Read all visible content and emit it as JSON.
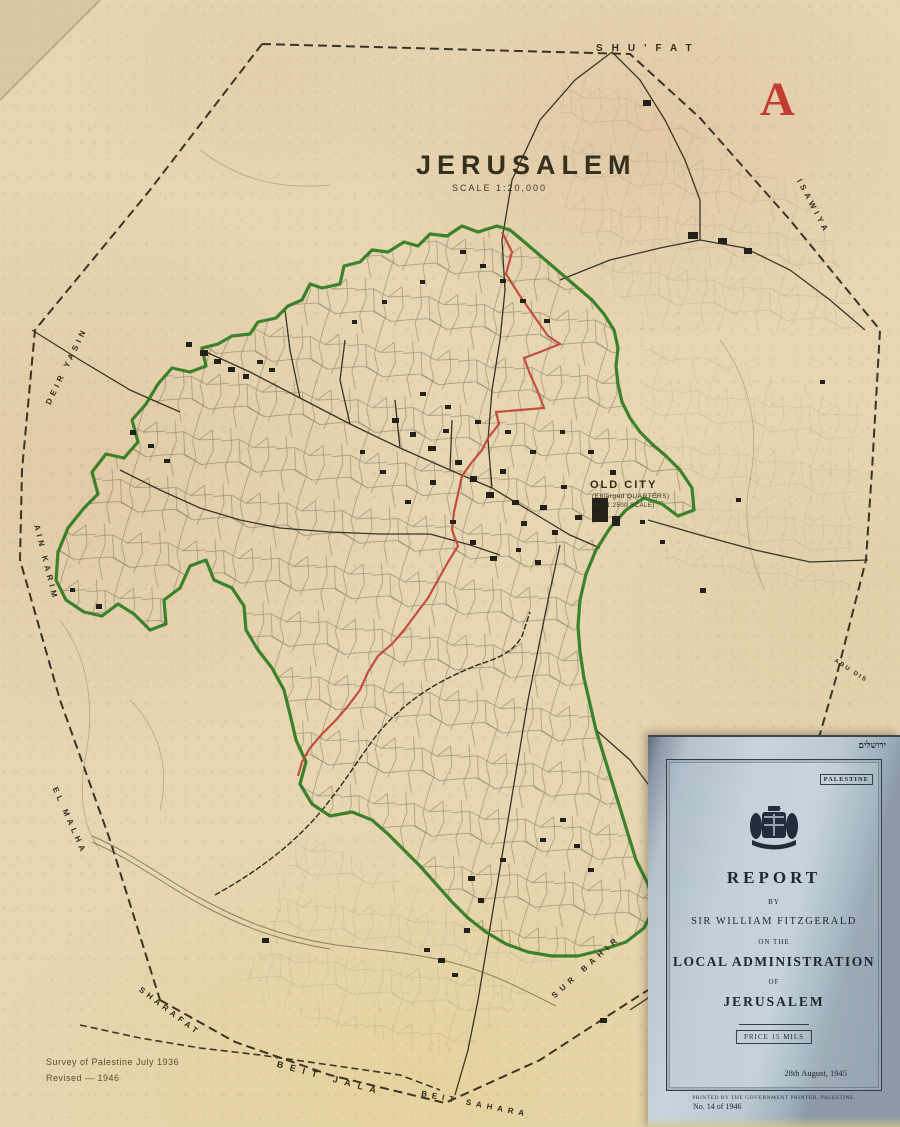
{
  "map": {
    "title": "JERUSALEM",
    "scale": "SCALE  1:20,000",
    "sheet_letter": "A",
    "credit1": "Survey of Palestine  July 1936",
    "credit2": "Revised — 1946",
    "labels": {
      "shufat": "SHU'FAT",
      "deir_yasin": "DEIR YASIN",
      "ain_karim": "AIN KARIM",
      "el_malha": "EL MALHA",
      "sharafat": "SHARAFAT",
      "beit_jala": "BEIT JALA",
      "beit_sahara": "BEIT SAHARA",
      "sur_bahir": "SUR BAHIR",
      "isawiya": "ISAWIYA",
      "abu_dis": "ABU DIS",
      "old_city": "OLD CITY",
      "old_city_sub1": "(Enlarged QUARTERS)",
      "old_city_sub2": "(ON 1:2500 SCALE)"
    },
    "colors": {
      "paper": "#e6d6b2",
      "ink": "#33301f",
      "municipal_boundary_green": "#2e7a1f",
      "ward_division_red": "#c0483a",
      "sheet_letter_red": "#c23c33"
    }
  },
  "inset": {
    "hebrew_title": "ירושלים",
    "country": "PALESTINE",
    "title": "REPORT",
    "by": "BY",
    "author": "SIR WILLIAM FITZGERALD",
    "on_the": "ON THE",
    "subject1": "LOCAL ADMINISTRATION",
    "of": "OF",
    "subject2": "JERUSALEM",
    "price": "PRICE 15 MILS",
    "date": "28th August, 1945",
    "number": "No. 14 of 1946",
    "printer": "PRINTED BY THE GOVERNMENT PRINTER, PALESTINE.",
    "colors": {
      "cover_paper": "#c2d0da",
      "cover_ink": "#1d2633"
    }
  }
}
